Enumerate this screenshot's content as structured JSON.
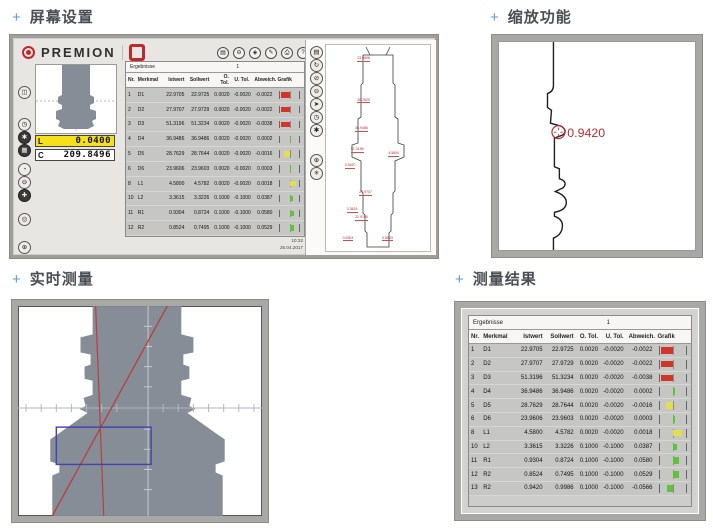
{
  "sections": {
    "screen_setup": {
      "plus": "+",
      "title": "屏幕设置"
    },
    "zoom_function": {
      "plus": "+",
      "title": "缩放功能"
    },
    "live_measure": {
      "plus": "+",
      "title": "实时测量"
    },
    "results": {
      "plus": "+",
      "title": "测量结果"
    }
  },
  "premion": {
    "brand": "PREMION",
    "window_icons": [
      {
        "name": "monitor-icon",
        "glyph": "▤"
      },
      {
        "name": "zoom-out-icon",
        "glyph": "⊖"
      },
      {
        "name": "diamond-icon",
        "glyph": "◈"
      },
      {
        "name": "edit-icon",
        "glyph": "✎"
      },
      {
        "name": "print-icon",
        "glyph": "⎙"
      },
      {
        "name": "help-icon",
        "glyph": "?"
      }
    ],
    "left_icons": [
      {
        "name": "measure-icon",
        "glyph": "◫",
        "dark": false
      },
      {
        "name": "clock-icon",
        "glyph": "◷",
        "dark": false
      },
      {
        "name": "gear-icon",
        "glyph": "✱",
        "dark": true
      },
      {
        "name": "grid-icon",
        "glyph": "▦",
        "dark": true
      },
      {
        "name": "probe-icon",
        "glyph": "◔",
        "dark": false
      },
      {
        "name": "minus-icon",
        "glyph": "⊖",
        "dark": false
      },
      {
        "name": "crosshair-icon",
        "glyph": "✚",
        "dark": true
      },
      {
        "name": "target-icon",
        "glyph": "◎",
        "dark": false
      },
      {
        "name": "center-icon",
        "glyph": "⊕",
        "dark": false
      }
    ],
    "right_icons": [
      {
        "name": "notes-icon",
        "glyph": "▤",
        "dark": false
      },
      {
        "name": "redo-icon",
        "glyph": "↻",
        "dark": false
      },
      {
        "name": "disable-icon",
        "glyph": "⊘",
        "dark": false
      },
      {
        "name": "minus-icon",
        "glyph": "⊖",
        "dark": false
      },
      {
        "name": "cursor-icon",
        "glyph": "➤",
        "dark": false
      },
      {
        "name": "time-icon",
        "glyph": "◷",
        "dark": false
      },
      {
        "name": "settings-icon",
        "glyph": "✱",
        "dark": false
      },
      {
        "name": "align-icon",
        "glyph": "⊕",
        "dark": false
      },
      {
        "name": "star-icon",
        "glyph": "✳",
        "dark": false
      }
    ],
    "print_glyph": "⎙",
    "close_glyph": "✕",
    "readouts": [
      {
        "label": "L",
        "value": "0.0400"
      },
      {
        "label": "C",
        "value": "209.8496"
      }
    ],
    "clock": {
      "time": "10:32",
      "date": "26.04.2017"
    },
    "profile_labels": [
      "23.9606",
      "28.7629",
      "36.9486",
      "51.3196",
      "4.5800",
      "0.9420",
      "27.9707",
      "3.3615",
      "22.9705",
      "0.9304",
      "0.8524"
    ]
  },
  "results_table": {
    "title": "Ergebnisse",
    "tab_label": "1",
    "columns": [
      "Nr.",
      "Merkmal",
      "Istwert",
      "Sollwert",
      "O. Tol.",
      "U. Tol.",
      "Abweich.",
      "Grafik"
    ],
    "rows": [
      {
        "nr": "1",
        "merkmal": "D1",
        "istwert": "22.9705",
        "sollwert": "22.9725",
        "o_tol": "0.0020",
        "u_tol": "-0.0020",
        "abweich": "-0.0022",
        "bar": {
          "color": "#d0342a",
          "pct": 46,
          "side": "neg"
        }
      },
      {
        "nr": "2",
        "merkmal": "D2",
        "istwert": "27.9707",
        "sollwert": "27.9729",
        "o_tol": "0.0020",
        "u_tol": "-0.0020",
        "abweich": "-0.0022",
        "bar": {
          "color": "#d0342a",
          "pct": 46,
          "side": "neg"
        }
      },
      {
        "nr": "3",
        "merkmal": "D3",
        "istwert": "51.3196",
        "sollwert": "51.3234",
        "o_tol": "0.0020",
        "u_tol": "-0.0020",
        "abweich": "-0.0038",
        "bar": {
          "color": "#d0342a",
          "pct": 48,
          "side": "neg"
        }
      },
      {
        "nr": "4",
        "merkmal": "D4",
        "istwert": "36.9486",
        "sollwert": "36.9486",
        "o_tol": "0.0020",
        "u_tol": "-0.0020",
        "abweich": "0.0002",
        "bar": {
          "color": "#5fc23a",
          "pct": 6,
          "side": "pos"
        }
      },
      {
        "nr": "5",
        "merkmal": "D5",
        "istwert": "28.7629",
        "sollwert": "28.7644",
        "o_tol": "0.0020",
        "u_tol": "-0.0020",
        "abweich": "-0.0016",
        "bar": {
          "color": "#e3de4e",
          "pct": 30,
          "side": "neg"
        }
      },
      {
        "nr": "6",
        "merkmal": "D6",
        "istwert": "23.9606",
        "sollwert": "23.9603",
        "o_tol": "0.0020",
        "u_tol": "-0.0020",
        "abweich": "0.0003",
        "bar": {
          "color": "#5fc23a",
          "pct": 6,
          "side": "pos"
        }
      },
      {
        "nr": "8",
        "merkmal": "L1",
        "istwert": "4.5800",
        "sollwert": "4.5782",
        "o_tol": "0.0020",
        "u_tol": "-0.0020",
        "abweich": "0.0018",
        "bar": {
          "color": "#e3de4e",
          "pct": 34,
          "side": "pos"
        }
      },
      {
        "nr": "10",
        "merkmal": "L2",
        "istwert": "3.3615",
        "sollwert": "3.3226",
        "o_tol": "0.1000",
        "u_tol": "-0.1000",
        "abweich": "0.0387",
        "bar": {
          "color": "#5fc23a",
          "pct": 16,
          "side": "pos"
        }
      },
      {
        "nr": "11",
        "merkmal": "R1",
        "istwert": "0.9304",
        "sollwert": "0.8724",
        "o_tol": "0.1000",
        "u_tol": "-0.1000",
        "abweich": "0.0580",
        "bar": {
          "color": "#5fc23a",
          "pct": 24,
          "side": "pos"
        }
      },
      {
        "nr": "12",
        "merkmal": "R2",
        "istwert": "0.8524",
        "sollwert": "0.7495",
        "o_tol": "0.1000",
        "u_tol": "-0.1000",
        "abweich": "0.0529",
        "bar": {
          "color": "#5fc23a",
          "pct": 22,
          "side": "pos"
        }
      },
      {
        "nr": "13",
        "merkmal": "R2",
        "istwert": "0.9420",
        "sollwert": "0.9986",
        "o_tol": "0.1000",
        "u_tol": "-0.1000",
        "abweich": "-0.0566",
        "bar": {
          "color": "#5fc23a",
          "pct": 24,
          "side": "neg"
        }
      }
    ]
  },
  "zoom_view": {
    "marker_value": "0.9420"
  },
  "colors": {
    "accent_blue": "#5b9bd5",
    "logo_red": "#c3272b",
    "bar_red": "#d0342a",
    "bar_yellow": "#e3de4e",
    "bar_green": "#5fc23a",
    "line_red": "#b5413c",
    "rect_blue": "#4343ae",
    "silhouette_gray": "#868d97"
  }
}
